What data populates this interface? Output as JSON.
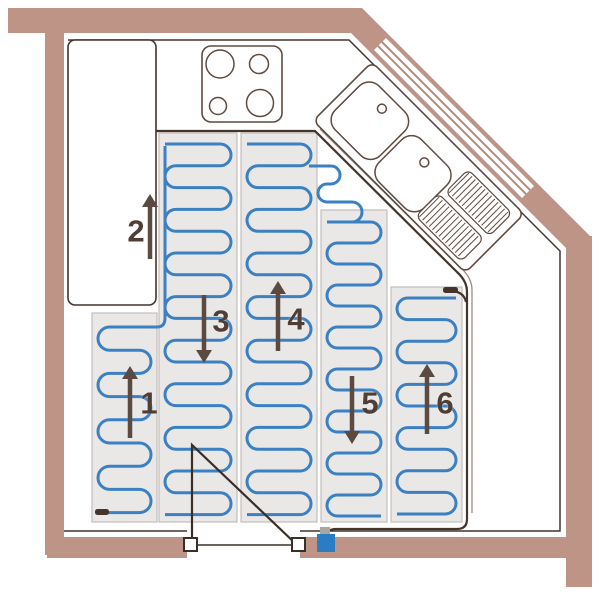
{
  "title": "kitchen-underfloor-heating-mat-layout",
  "colors": {
    "wall": "#bd9486",
    "window_stripe": "#b48c7d",
    "floor": "#ffffff",
    "mat_fill": "#eae8e6",
    "mat_border": "#c3bebA",
    "coil": "#3b80c2",
    "outline": "#44342c",
    "boundary": "#44342c",
    "boundary_shadow": "#9b8c83",
    "fixture": "#5d4b42",
    "arrow": "#5a4a42",
    "label": "#4e3e35",
    "thermostat": "#2a7cc3",
    "connector": "#a8a5a2"
  },
  "labels": [
    {
      "text": "1",
      "x": 149,
      "y": 403
    },
    {
      "text": "2",
      "x": 136,
      "y": 231
    },
    {
      "text": "3",
      "x": 221,
      "y": 321
    },
    {
      "text": "4",
      "x": 296,
      "y": 319
    },
    {
      "text": "5",
      "x": 370,
      "y": 403
    },
    {
      "text": "6",
      "x": 445,
      "y": 403
    }
  ],
  "arrows": [
    {
      "x": 130,
      "y1": 438,
      "y2": 366
    },
    {
      "x": 150,
      "y1": 259,
      "y2": 194
    },
    {
      "x": 204,
      "y1": 295,
      "y2": 363
    },
    {
      "x": 278,
      "y1": 351,
      "y2": 281
    },
    {
      "x": 352,
      "y1": 376,
      "y2": 444
    },
    {
      "x": 427,
      "y1": 434,
      "y2": 364
    }
  ],
  "walls": {
    "top": [
      8,
      8,
      354,
      25
    ],
    "left": [
      45,
      33,
      19,
      522
    ],
    "bottom_left": [
      47,
      537,
      140,
      21
    ],
    "bottom_right": [
      300,
      537,
      292,
      21
    ],
    "right": [
      566,
      236,
      26,
      351
    ],
    "diagonal": [
      [
        362,
        8
      ],
      [
        590,
        236
      ],
      [
        572,
        254
      ],
      [
        344,
        26
      ]
    ],
    "window_white": [
      [
        386,
        38
      ],
      [
        534,
        186
      ],
      [
        522,
        198
      ],
      [
        374,
        50
      ]
    ],
    "window_stripes": [
      [
        382,
        42,
        530,
        190
      ],
      [
        378,
        46,
        526,
        194
      ]
    ]
  },
  "interior_outline": [
    "M 68 40 H 349 L 560 251 V 531 H 300",
    "M 187 531 H 64"
  ],
  "counter": {
    "x": 68,
    "y": 40,
    "w": 88,
    "h": 265,
    "rx": 7
  },
  "heated_boundary": {
    "main": "M 156 131 H 315 L 457 272 Q 467 281 467 292 L 467 519 Q 467 529 457 529 L 336 529 Q 328 529 328 535",
    "shadow": "M 320 129 L 461 268 Q 472 278 472 290 L 472 513",
    "tail_link": "M 452 291 Q 464 292 466 302"
  },
  "mats": [
    {
      "id": "mat-1",
      "x": 92,
      "y": 313,
      "w": 65,
      "h": 209,
      "coil": {
        "first": 327,
        "spacing": 23.2,
        "runs": 9,
        "start": "right"
      }
    },
    {
      "id": "mat-2",
      "x": 159,
      "y": 133,
      "w": 78,
      "h": 389,
      "coil": {
        "first": 144,
        "spacing": 21.8,
        "runs": 18,
        "start": "left"
      }
    },
    {
      "id": "mat-3",
      "x": 241,
      "y": 133,
      "w": 76,
      "h": 389,
      "coil": {
        "first": 144,
        "spacing": 21.8,
        "runs": 18,
        "start": "left"
      }
    },
    {
      "id": "mat-4",
      "x": 321,
      "y": 210,
      "w": 66,
      "h": 312,
      "coil": {
        "first": 222,
        "spacing": 21.0,
        "runs": 15,
        "start": "left"
      }
    },
    {
      "id": "mat-5",
      "x": 391,
      "y": 287,
      "w": 71,
      "h": 235,
      "coil": {
        "first": 298,
        "spacing": 21.6,
        "runs": 11,
        "start": "right"
      }
    }
  ],
  "coil_links": {
    "left_riser": "M 165 146 V 318 Q 165 327 157 327 L 151 327",
    "sink_wiggle": "M 309 166 H 331 A 9 9 0 0 1 331 184 H 327 A 9 9 0 0 0 327 202 H 352 A 10 10 0 0 1 352 222 H 333"
  },
  "terminals": [
    {
      "x": 443,
      "y": 287,
      "w": 15,
      "h": 6
    },
    {
      "x": 95,
      "y": 509,
      "w": 14,
      "h": 6
    }
  ],
  "cooktop": {
    "x": 202,
    "y": 46,
    "w": 80,
    "h": 76,
    "rx": 9,
    "burners": [
      [
        220,
        64,
        14
      ],
      [
        259,
        64,
        9.5
      ],
      [
        218,
        106,
        8.5
      ],
      [
        260,
        103,
        13.5
      ]
    ]
  },
  "sink": {
    "tx": 372,
    "ty": 62,
    "angle": 45,
    "len": 215,
    "depth": 83,
    "rx": 7,
    "basins": [
      [
        8,
        12,
        64,
        62,
        14
      ],
      [
        76,
        20,
        64,
        60,
        14
      ]
    ],
    "holes": [
      [
        40,
        26,
        4.5
      ],
      [
        108,
        34,
        4.5
      ]
    ],
    "pads": [
      [
        144,
        8,
        62,
        32
      ],
      [
        140,
        46,
        64,
        32
      ]
    ],
    "pad_rx": 6,
    "hatch_step": 4.6
  },
  "door": {
    "swing": "M 192 545 V 445 L 297 545",
    "threshold": "M 197 545 H 292",
    "posts": [
      [
        184,
        538,
        13
      ],
      [
        292,
        538,
        13
      ]
    ]
  },
  "thermostat": {
    "x": 317,
    "y": 534,
    "w": 18,
    "h": 18,
    "connector": [
      320,
      527,
      10,
      8
    ]
  }
}
